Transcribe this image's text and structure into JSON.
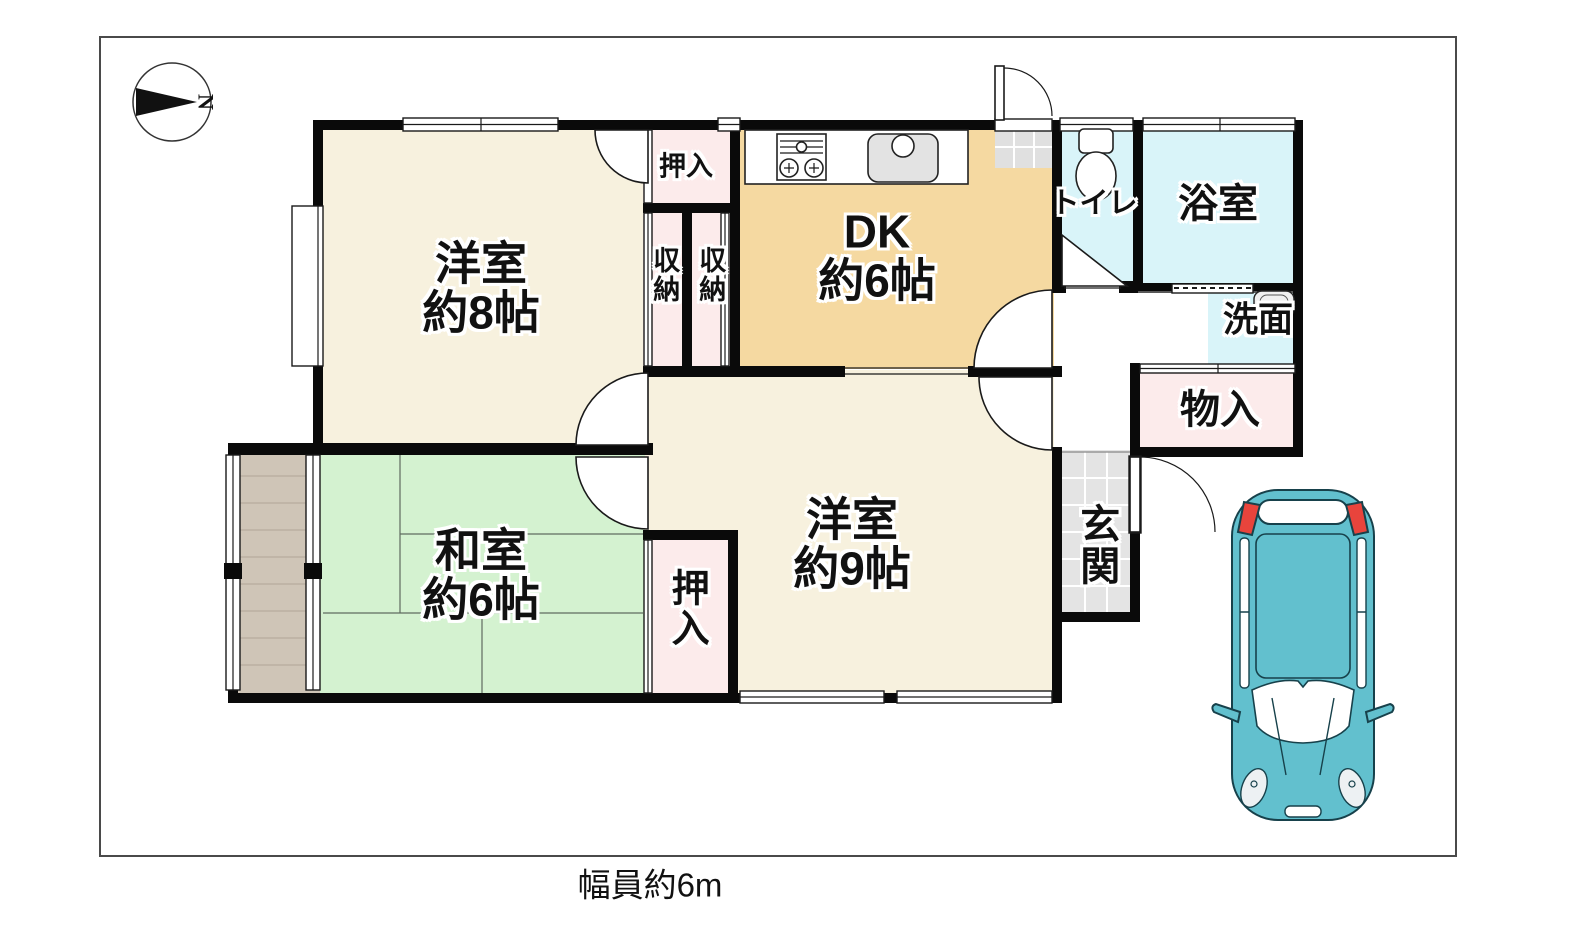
{
  "page": {
    "road_label": "幅員約6m"
  },
  "compass": {
    "label": "N"
  },
  "colors": {
    "wall": "#0a0a0a",
    "boundary": "#4a4a4a",
    "room_cream": "#f7f1de",
    "room_dk": "#f5d9a1",
    "room_tatami": "#d4f2d0",
    "room_water": "#d9f4f9",
    "room_closet": "#fcebeb",
    "room_genkan": "#e4e4e4",
    "room_veranda": "#cfc5b7",
    "step_gray": "#e0e0e0",
    "car_body": "#62c0ce",
    "car_taillight": "#e8443c"
  },
  "rooms": {
    "western8": {
      "name": "洋室",
      "size": "約8帖"
    },
    "dk": {
      "name": "DK",
      "size": "約6帖"
    },
    "western9": {
      "name": "洋室",
      "size": "約9帖"
    },
    "japanese6": {
      "name": "和室",
      "size": "約6帖"
    },
    "toilet": {
      "label": "トイレ"
    },
    "bath": {
      "label": "浴室"
    },
    "washroom": {
      "label": "洗面"
    },
    "storage": {
      "label": "物入"
    },
    "entrance": {
      "label": "玄関"
    },
    "closet_top": {
      "label": "押入"
    },
    "closet_bottom": {
      "label": "押入"
    },
    "shuno_left": {
      "label": "収納"
    },
    "shuno_right": {
      "label": "収納"
    }
  },
  "icons": {
    "compass": "north-arrow",
    "stove": "gas-stove",
    "kitchen_sink": "kitchen-sink",
    "toilet_bowl": "toilet-bowl",
    "washbasin": "washbasin",
    "car": "car-top-view"
  }
}
